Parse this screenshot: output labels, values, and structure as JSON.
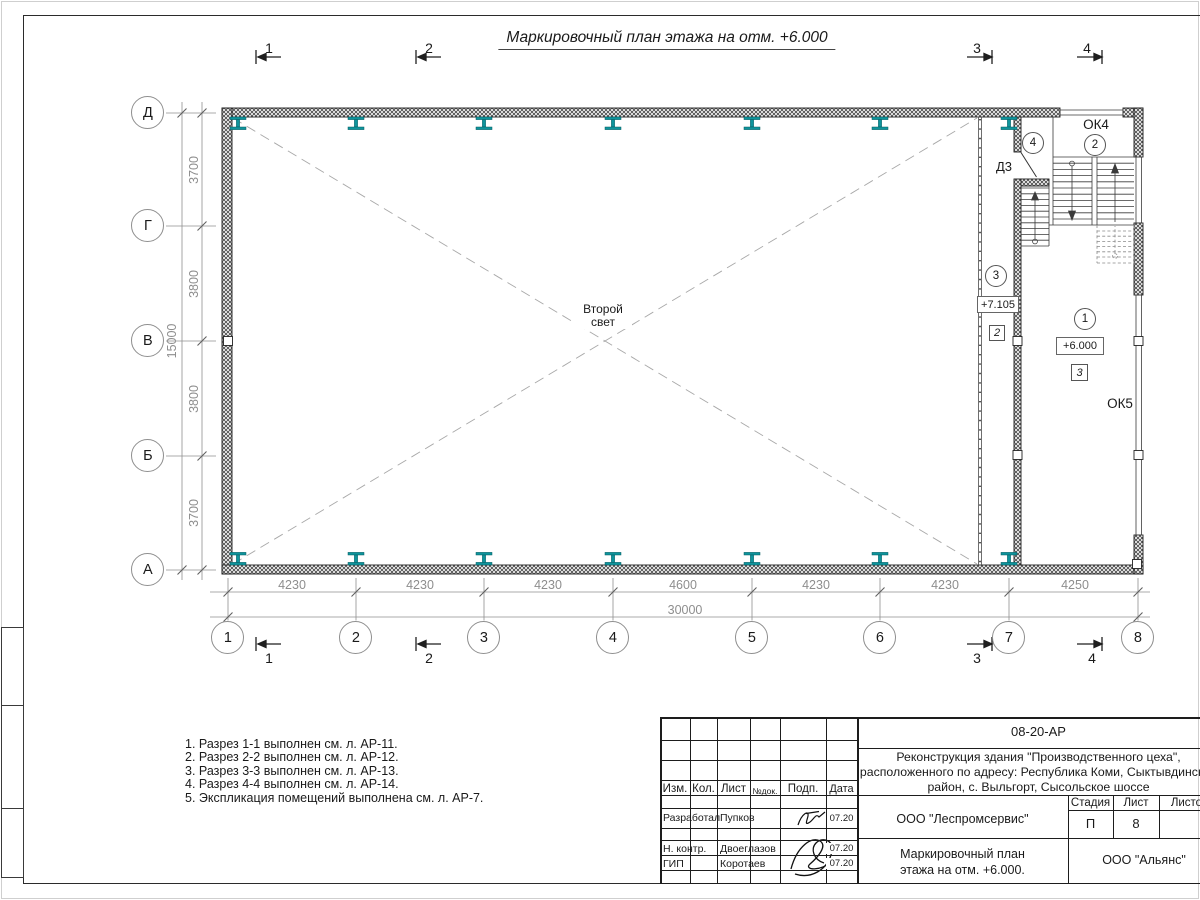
{
  "title": "Маркировочный план этажа на отм. +6.000",
  "colors": {
    "steel_column": "#0f949c"
  },
  "plan": {
    "row_axes": [
      "Д",
      "Г",
      "В",
      "Б",
      "А"
    ],
    "col_axes": [
      "1",
      "2",
      "3",
      "4",
      "5",
      "6",
      "7",
      "8"
    ],
    "row_dims": [
      "3700",
      "3800",
      "3800",
      "3700"
    ],
    "row_total": "15000",
    "col_dims": [
      "4230",
      "4230",
      "4230",
      "4600",
      "4230",
      "4230",
      "4250"
    ],
    "col_total": "30000",
    "sections": {
      "s1": "1",
      "s2": "2",
      "s3": "3",
      "s4": "4"
    },
    "labels": {
      "second_light": "Второй свет",
      "window_top": "ОК4",
      "window_right": "ОК5",
      "door": "Д3",
      "elev_corridor": "+7.105",
      "elev_main": "+6.000",
      "room_1": "1",
      "room_2": "2",
      "room_3": "3",
      "room_4": "4",
      "node_2": "2",
      "node_3": "3"
    }
  },
  "notes": [
    "1. Разрез 1-1 выполнен см. л. АР-11.",
    "2. Разрез 2-2 выполнен см. л. АР-12.",
    "3. Разрез 3-3 выполнен см. л. АР-13.",
    "4. Разрез 4-4 выполнен см. л. АР-14.",
    "5. Экспликация помещений выполнена см. л. АР-7."
  ],
  "titleblock": {
    "doc_code": "08-20-АР",
    "project_line1": "Реконструкция здания \"Производственного цеха\",",
    "project_line2": "расположенного по адресу: Республика Коми, Сыктывдинский",
    "project_line3": "район, с. Выльгорт, Сысольское шоссе",
    "columns": {
      "izm": "Изм.",
      "kol": "Кол.",
      "list": "Лист",
      "ndoc": "№док.",
      "podp": "Подп.",
      "data": "Дата"
    },
    "rows": [
      {
        "role": "Разработал",
        "name": "Пупков",
        "date": "07.20"
      },
      {
        "role": "Н. контр.",
        "name": "Двоеглазов",
        "date": "07.20"
      },
      {
        "role": "ГИП",
        "name": "Коротаев",
        "date": "07.20"
      }
    ],
    "org": "ООО \"Леспромсервис\"",
    "drawing_title_line1": "Маркировочный план",
    "drawing_title_line2": "этажа на отм. +6.000.",
    "stage_label": "Стадия",
    "sheet_label": "Лист",
    "sheets_label": "Листов",
    "stage": "П",
    "sheet": "8",
    "customer": "ООО \"Альянс\""
  }
}
